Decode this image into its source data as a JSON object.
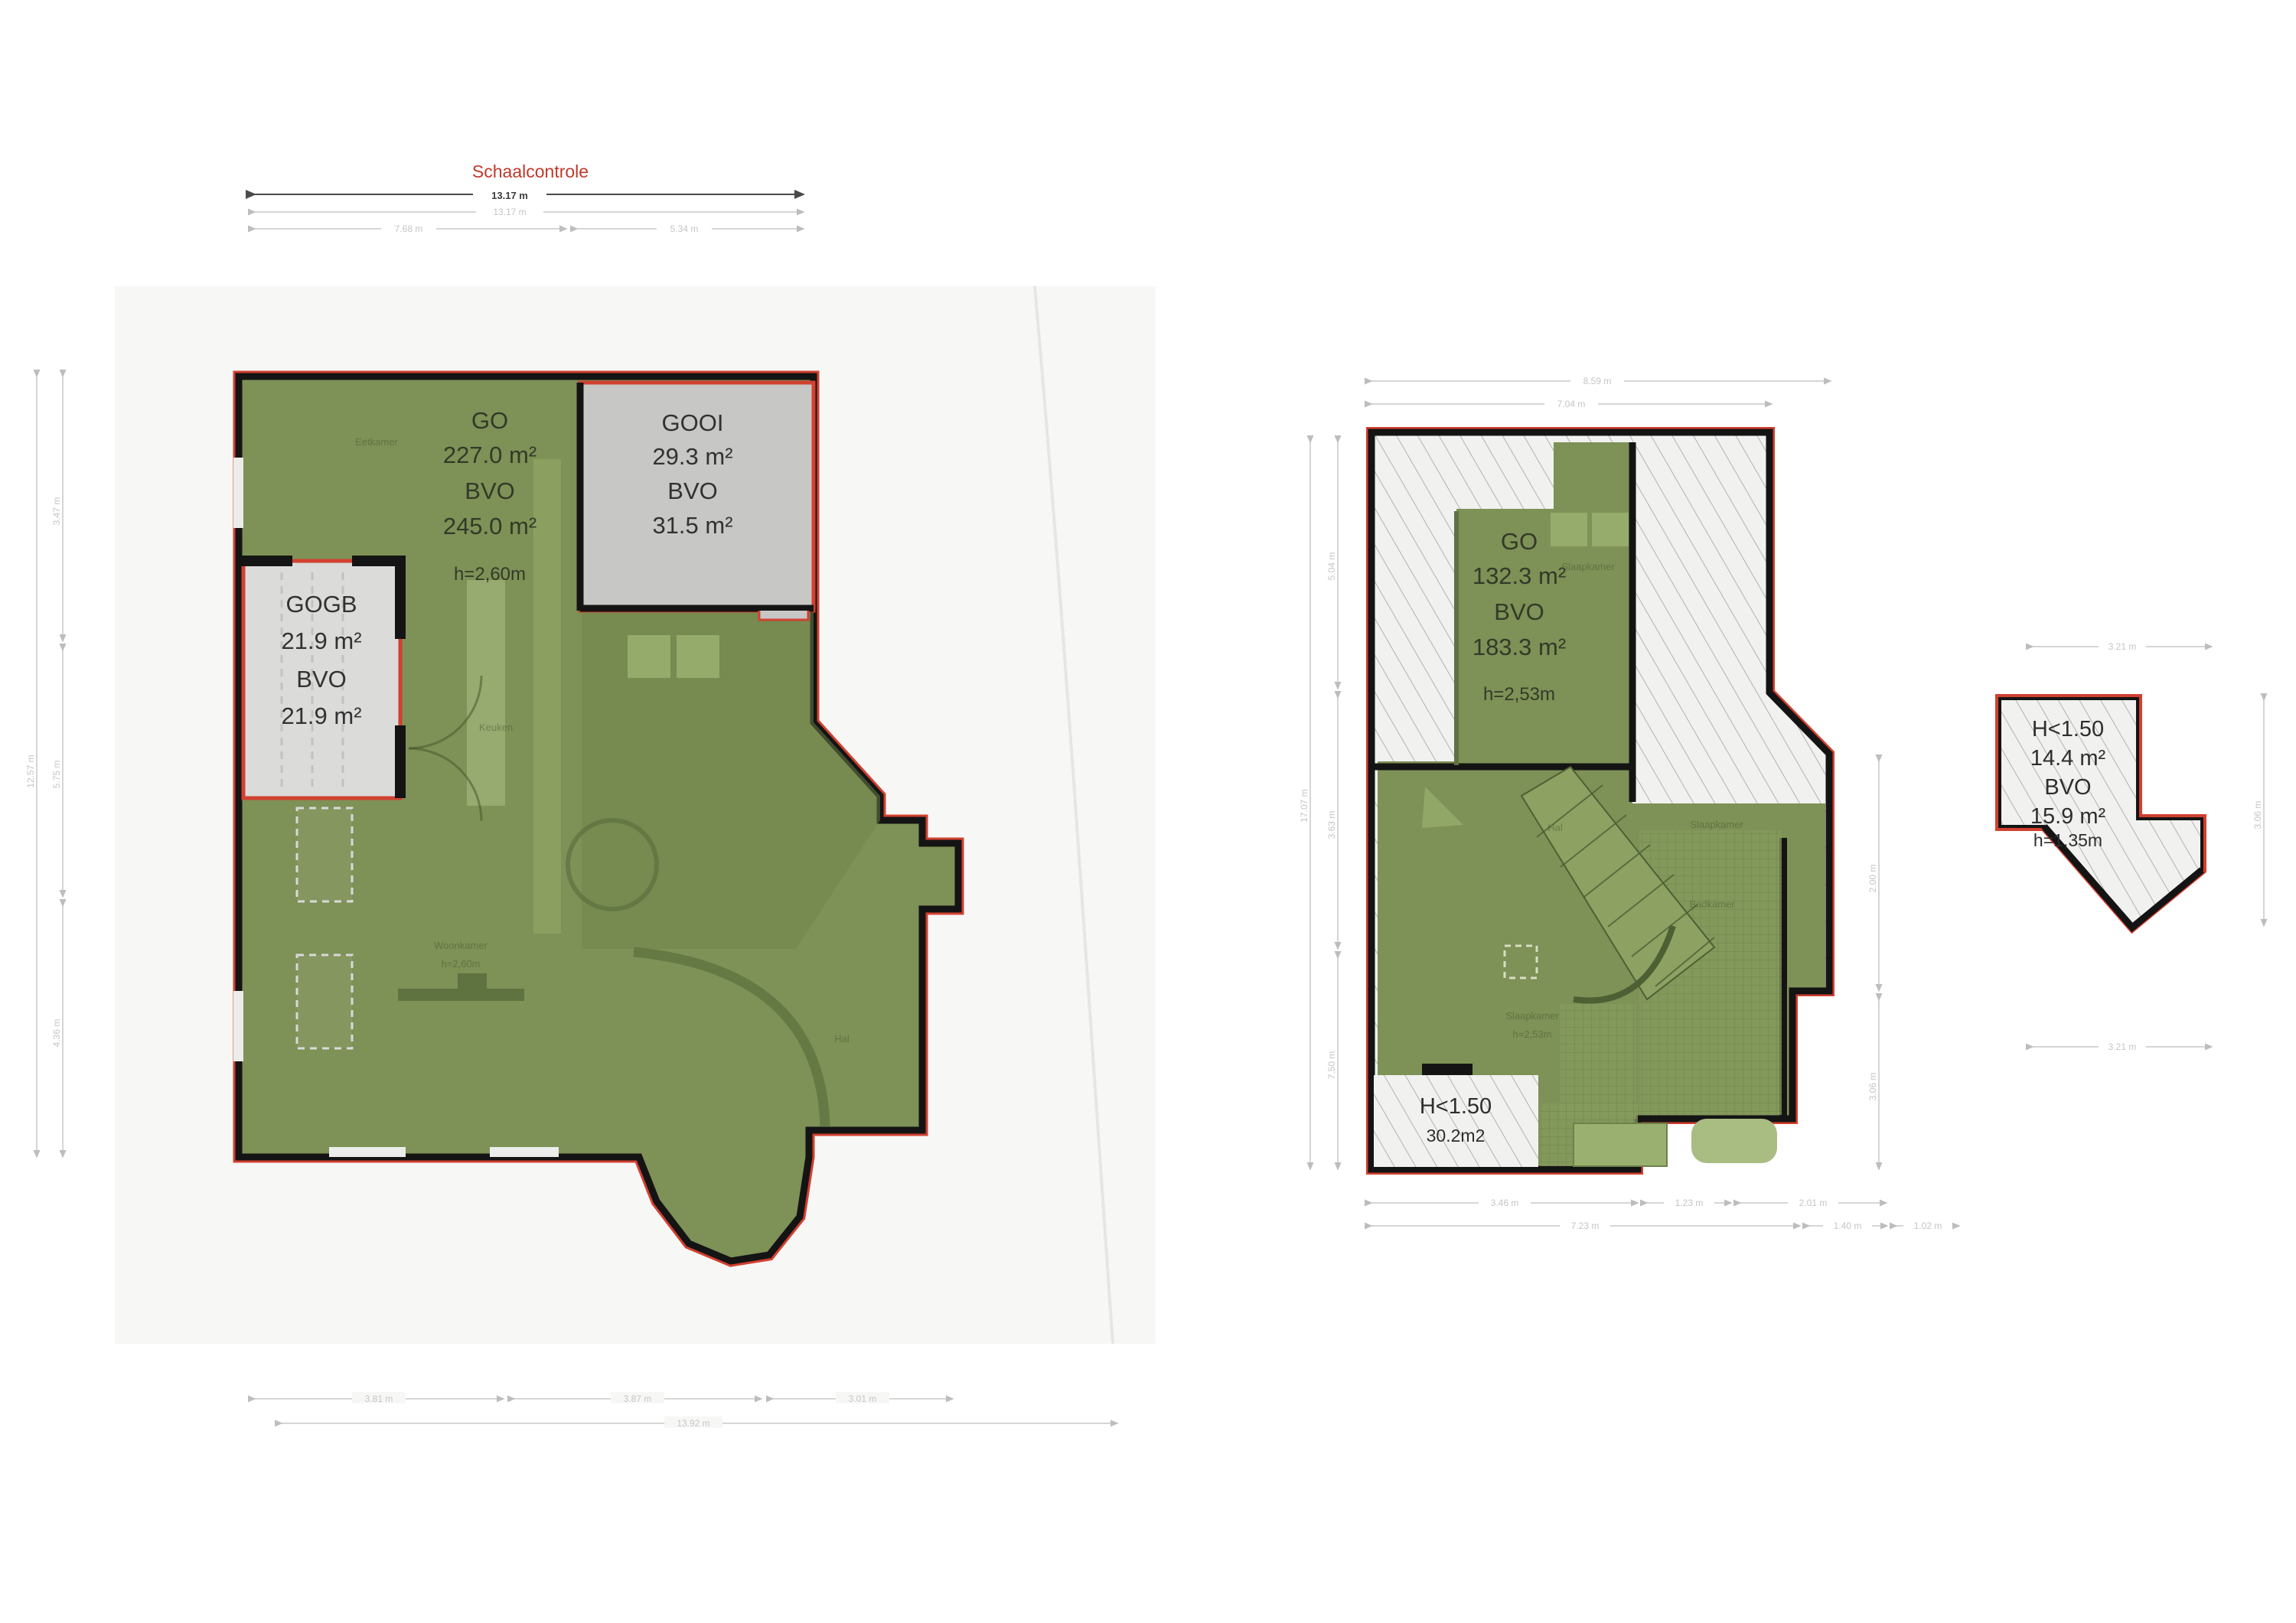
{
  "scale_check": {
    "title": "Schaalcontrole",
    "total_dark": "13.17 m",
    "total_light": "13.17 m",
    "seg_left": "7.68 m",
    "seg_right": "5.34 m"
  },
  "ground_floor": {
    "go_label": "GO",
    "go_value": "227.0 m²",
    "bvo_label": "BVO",
    "bvo_value": "245.0 m²",
    "height": "h=2,60m",
    "gooi": {
      "name": "GOOI",
      "area": "29.3 m²",
      "bvo_label": "BVO",
      "bvo_area": "31.5 m²"
    },
    "gogb": {
      "name": "GOGB",
      "area": "21.9 m²",
      "bvo_label": "BVO",
      "bvo_area": "21.9 m²"
    },
    "rooms": {
      "dining": "Eetkamer",
      "kitchen": "Keuken",
      "living": "Woonkamer",
      "living_height": "h=2,60m",
      "hall": "Hal"
    },
    "dims": {
      "left_total": "12.57 m",
      "left_segments": [
        "3.47 m",
        "5.75 m",
        "4.36 m"
      ],
      "bottom_segments": [
        "3.81 m",
        "3.87 m",
        "3.01 m"
      ],
      "bottom_total": "13.92 m"
    }
  },
  "first_floor": {
    "go_label": "GO",
    "go_value": "132.3 m²",
    "bvo_label": "BVO",
    "bvo_value": "183.3 m²",
    "height": "h=2,53m",
    "low_zone": {
      "line1": "H<1.50",
      "line2": "30.2m2"
    },
    "rooms": {
      "hall": "Hal",
      "bedroom_top": "Slaapkamer",
      "bedroom_mid": "Slaapkamer",
      "bathroom": "Badkamer",
      "bedroom_bottom": "Slaapkamer",
      "bedroom_bottom_height": "h=2,53m"
    },
    "dims": {
      "top_total": "8.59 m",
      "top_inner": "7.04 m",
      "left_total": "17.07 m",
      "left_segments": [
        "5.04 m",
        "3.63 m",
        "7.50 m"
      ],
      "right_segments": [
        "2.00 m",
        "3.06 m"
      ],
      "bottom_segments": [
        "3.46 m",
        "1.23 m",
        "2.01 m"
      ],
      "bottom_total": "7.23 m",
      "bottom_extra": [
        "1.40 m",
        "1.02 m"
      ]
    }
  },
  "attic": {
    "line1": "H<1.50",
    "area": "14.4 m²",
    "bvo_label": "BVO",
    "bvo_area": "15.9 m²",
    "height": "h=1,35m",
    "dims": {
      "top": "3.21 m",
      "bottom": "3.21 m",
      "right": "3.06 m"
    }
  },
  "colors": {
    "floor_green": "#7E9156",
    "accent_red": "#D24030",
    "wall_black": "#141414",
    "room_gray": "#C7C7C6",
    "room_gray_light": "#DBDBDA",
    "backdrop": "#F7F7F6",
    "hatch_bg": "#F1F1F0"
  }
}
